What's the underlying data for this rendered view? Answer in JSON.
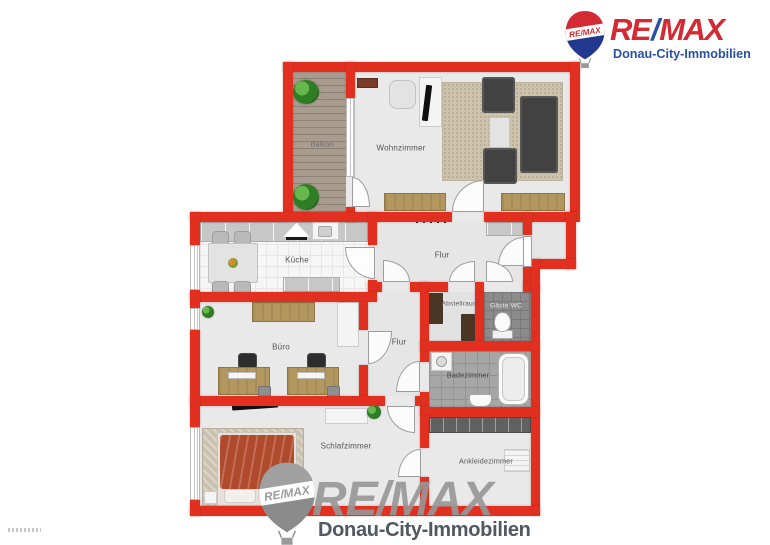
{
  "logo": {
    "re": "RE",
    "slash": "/",
    "max": "MAX",
    "subtitle": "Donau-City-Immobilien",
    "balloon_text": "RE/MAX"
  },
  "floorplan": {
    "rooms": {
      "balkon": "Balkon",
      "wohnzimmer": "Wohnzimmer",
      "kueche": "Küche",
      "flur_oben": "Flur",
      "abstellraum": "Abstellraum",
      "gaeste_wc": "Gäste WC",
      "buero": "Büro",
      "flur_unten": "Flur",
      "badezimmer": "Badezimmer",
      "schlafzimmer": "Schlafzimmer",
      "ankleidezimmer": "Ankleidezimmer"
    }
  },
  "watermark": {
    "re": "RE",
    "slash": "/",
    "max": "MAX",
    "subtitle": "Donau-City-Immobilien",
    "balloon_text": "RE/MAX"
  },
  "colors": {
    "wall_red": "#e1301f",
    "logo_red": "#d32a33",
    "logo_blue": "#2850a5",
    "watermark_gray": "#979797",
    "watermark_dark": "#48515d"
  }
}
